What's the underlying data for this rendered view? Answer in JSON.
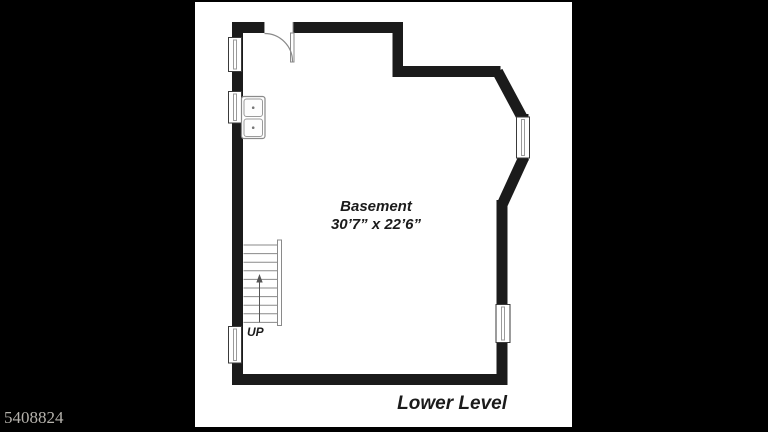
{
  "image": {
    "kind": "floor-plan listing photo",
    "width_px": 768,
    "height_px": 432
  },
  "colors": {
    "frame_background": "#000000",
    "paper": "#ffffff",
    "wall": "#1b1b1b",
    "detail_gray": "#8a8a8a",
    "watermark_text": "#b5b2ac"
  },
  "plan": {
    "room": {
      "name": "Basement",
      "dimensions": "30’7” x 22’6”"
    },
    "stairs": {
      "label": "UP"
    },
    "caption": "Lower Level",
    "photo_id": "5408824"
  }
}
